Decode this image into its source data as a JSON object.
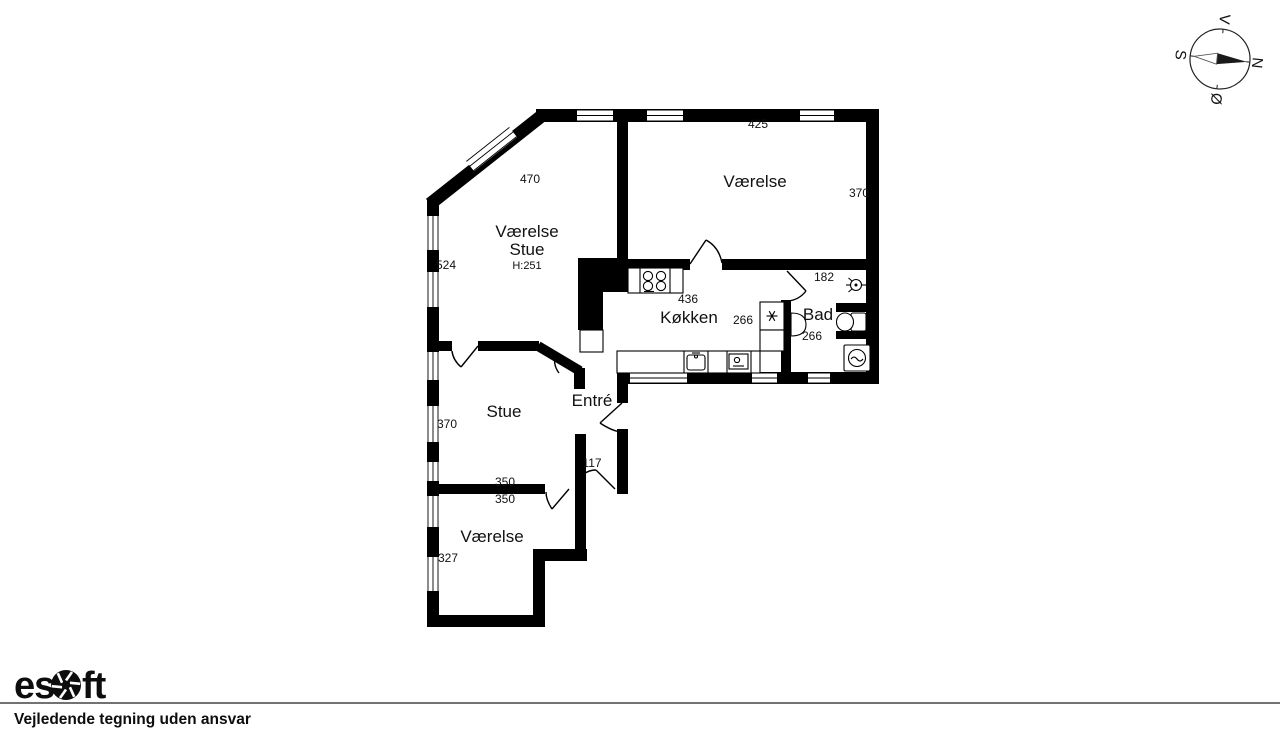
{
  "rooms": {
    "vaerelse_stue": {
      "line1": "Værelse",
      "line2": "Stue",
      "height": "H:251",
      "dim_top": "470",
      "dim_left": "524"
    },
    "vaerelse_ne": {
      "label": "Værelse",
      "dim_top": "425",
      "dim_right": "370"
    },
    "koekken": {
      "label": "Køkken",
      "dim_top": "436",
      "dim_right": "266"
    },
    "bad": {
      "label": "Bad",
      "dim_top": "182",
      "dim_bottom": "266"
    },
    "entre": {
      "label": "Entré",
      "dim_door": "117"
    },
    "stue": {
      "label": "Stue",
      "dim_left": "370",
      "dim_wall_above": "350",
      "dim_wall_below": "350"
    },
    "vaerelse_s": {
      "label": "Værelse",
      "dim_left": "327"
    }
  },
  "compass": {
    "north": "N",
    "south": "S",
    "east": "Ø",
    "west": "V"
  },
  "footer": {
    "logo_part1": "es",
    "logo_part2": "ft",
    "disclaimer": "Vejledende tegning uden ansvar"
  },
  "colors": {
    "wall": "#000000",
    "background": "#ffffff",
    "text": "#111111"
  }
}
